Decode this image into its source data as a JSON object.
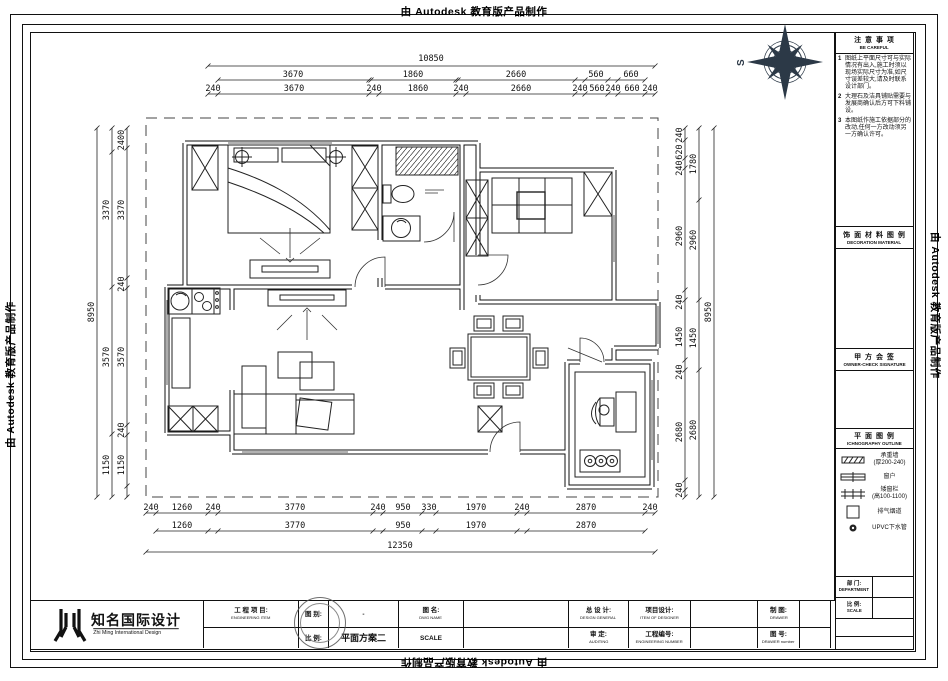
{
  "frame": {
    "autodesk_note": "由 Autodesk 教育版产品制作"
  },
  "compass": {
    "south_label": "S"
  },
  "plan": {
    "dims": {
      "top_total": "10850",
      "top_row2": [
        "3670",
        "1860",
        "2660",
        "560",
        "660"
      ],
      "top_row3": [
        "240",
        "3670",
        "240",
        "1860",
        "240",
        "2660",
        "240",
        "560",
        "240",
        "660",
        "240"
      ],
      "bottom_row1": [
        "240",
        "1260",
        "240",
        "3770",
        "240",
        "950",
        "330",
        "1970",
        "240",
        "2870",
        "240"
      ],
      "bottom_row2": [
        "1260",
        "3770",
        "950",
        "1970",
        "2870"
      ],
      "bottom_total": "12350",
      "left_total": "8950",
      "left_row1": [
        "2400",
        "3370",
        "240",
        "3570",
        "240",
        "1150"
      ],
      "left_row2": [
        "3370",
        "3570",
        "1150"
      ],
      "right_total": "8950",
      "right_row1": [
        "240",
        "620",
        "240",
        "2960",
        "240",
        "1450",
        "240",
        "2680",
        "240"
      ],
      "right_row2": [
        "1780",
        "2960",
        "1450",
        "2680"
      ]
    }
  },
  "sidebar": {
    "notice": {
      "title_cn": "注 意 事 项",
      "title_en": "BE CAREFUL",
      "notes": [
        {
          "num": "1",
          "text": "图纸上平面尺寸可与实际情况有出入,施工时须以现场实际尺寸为准,如尺寸误差较大,请及时联系设计部门。"
        },
        {
          "num": "2",
          "text": "大理石及洁具铺贴需要与发展商确认后方可下料铺设。"
        },
        {
          "num": "3",
          "text": "本图纸作施工依据部分的改动,任何一方改动须另一方确认许可。"
        }
      ]
    },
    "material": {
      "title_cn": "饰 面 材 料 图 例",
      "title_en": "DECORATION MATERIAL"
    },
    "owner": {
      "title_cn": "甲 方 会 签",
      "title_en": "OWNER-CHECK SIGNATURE"
    },
    "outline": {
      "title_cn": "平 面 图 例",
      "title_en": "ICHNOGRAPHY OUTLINE"
    },
    "legend": [
      {
        "label": "承重墙",
        "sub": "(厚200-240)"
      },
      {
        "label": "窗户",
        "sub": ""
      },
      {
        "label": "矮窗栏",
        "sub": "(高100-1100)"
      },
      {
        "label": "排气烟道",
        "sub": ""
      },
      {
        "label": "UPVC下水管",
        "sub": ""
      }
    ],
    "dept_cn": "部 门:",
    "dept_en": "DEPARTMENT",
    "scale_cn": "比 例:",
    "scale_en": "SCALE"
  },
  "titleblock": {
    "logo_cn": "知名国际设计",
    "logo_en": "Zhi Ming International Design",
    "project_cn": "工 程 项 目:",
    "project_en": "ENGINEERING ITEM",
    "dwg_sort_cn": "图 别:",
    "dwg_sort_value": "-",
    "scale_small_cn": "比 例:",
    "dwg_name_cn": "图 名:",
    "dwg_name_en": "DWG NAME",
    "dwg_name_value": "平面方案二",
    "scale_en": "SCALE",
    "design_general_cn": "总 设 计:",
    "design_general_en": "DESIGN GENERAL",
    "auditing_cn": "审 定:",
    "auditing_en": "AUDITING",
    "item_designer_cn": "项目设计:",
    "item_designer_en": "ITEM OF DESIGNER",
    "eng_number_cn": "工程编号:",
    "eng_number_en": "ENGINEERING NUMBER",
    "drawer_cn": "制 图:",
    "drawer_en": "DRAWER",
    "dwg_number_cn": "图 号:",
    "dwg_number_en": "DRAWER number"
  }
}
